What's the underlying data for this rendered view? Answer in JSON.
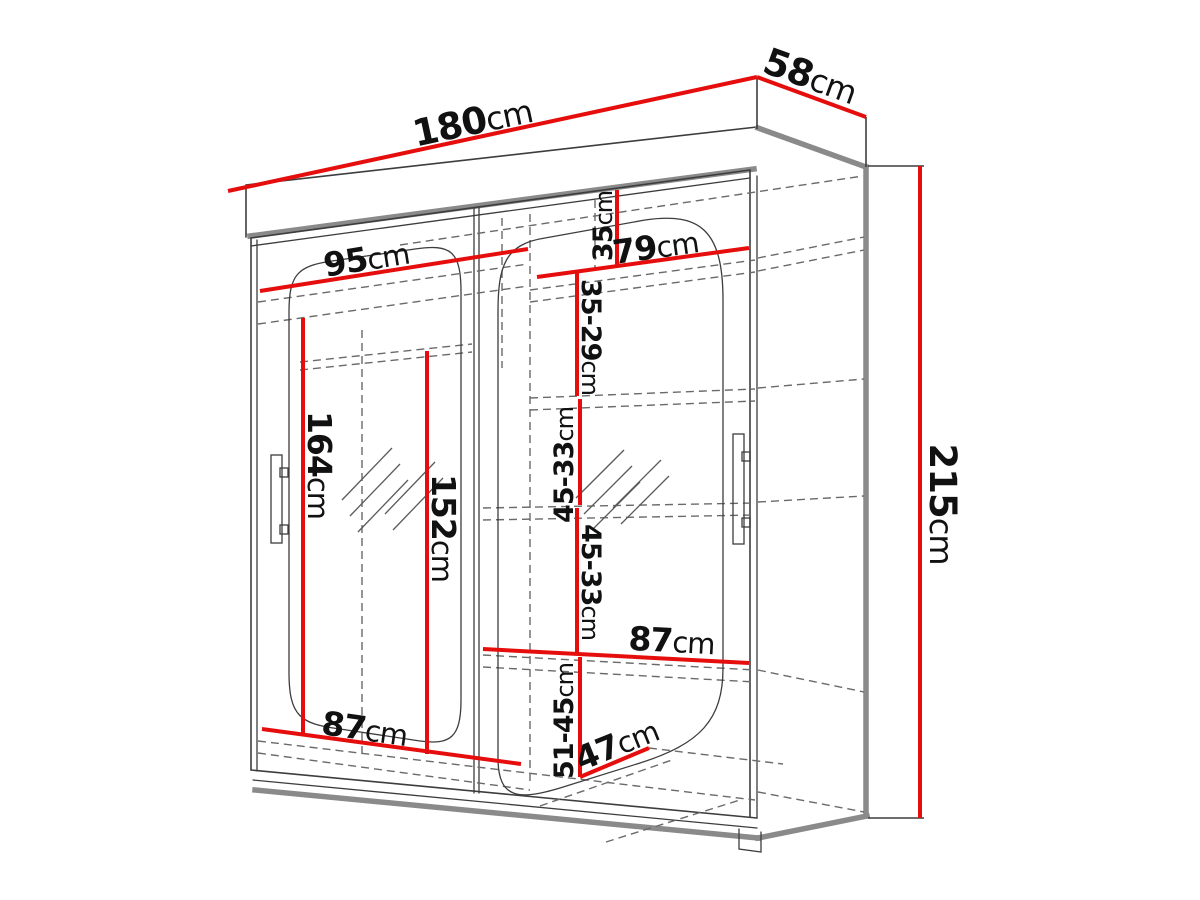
{
  "diagram": {
    "subject": "Sliding-door mirrored wardrobe - dimensioned technical drawing",
    "unit": "cm",
    "overall": {
      "width": "180",
      "depth": "58",
      "height": "215"
    },
    "dimensions": {
      "w180": {
        "value": "180",
        "unit": "cm"
      },
      "d58": {
        "value": "58",
        "unit": "cm"
      },
      "h215": {
        "value": "215",
        "unit": "cm"
      },
      "w95": {
        "value": "95",
        "unit": "cm"
      },
      "w79": {
        "value": "79",
        "unit": "cm"
      },
      "h35": {
        "value": "35",
        "unit": "cm"
      },
      "r35_29": {
        "value": "35-29",
        "unit": "cm"
      },
      "r45_33a": {
        "value": "45-33",
        "unit": "cm"
      },
      "r45_33b": {
        "value": "45-33",
        "unit": "cm"
      },
      "r51_45": {
        "value": "51-45",
        "unit": "cm"
      },
      "h164": {
        "value": "164",
        "unit": "cm"
      },
      "h152": {
        "value": "152",
        "unit": "cm"
      },
      "w87_left": {
        "value": "87",
        "unit": "cm"
      },
      "w87_right": {
        "value": "87",
        "unit": "cm"
      },
      "d47": {
        "value": "47",
        "unit": "cm"
      }
    },
    "colors": {
      "dimension_line": "#e60d0d",
      "outline": "#3d3d3d",
      "panel_gray": "#8a8a8a",
      "dashed": "#6a6a6a",
      "background": "#ffffff",
      "text": "#111111"
    }
  }
}
